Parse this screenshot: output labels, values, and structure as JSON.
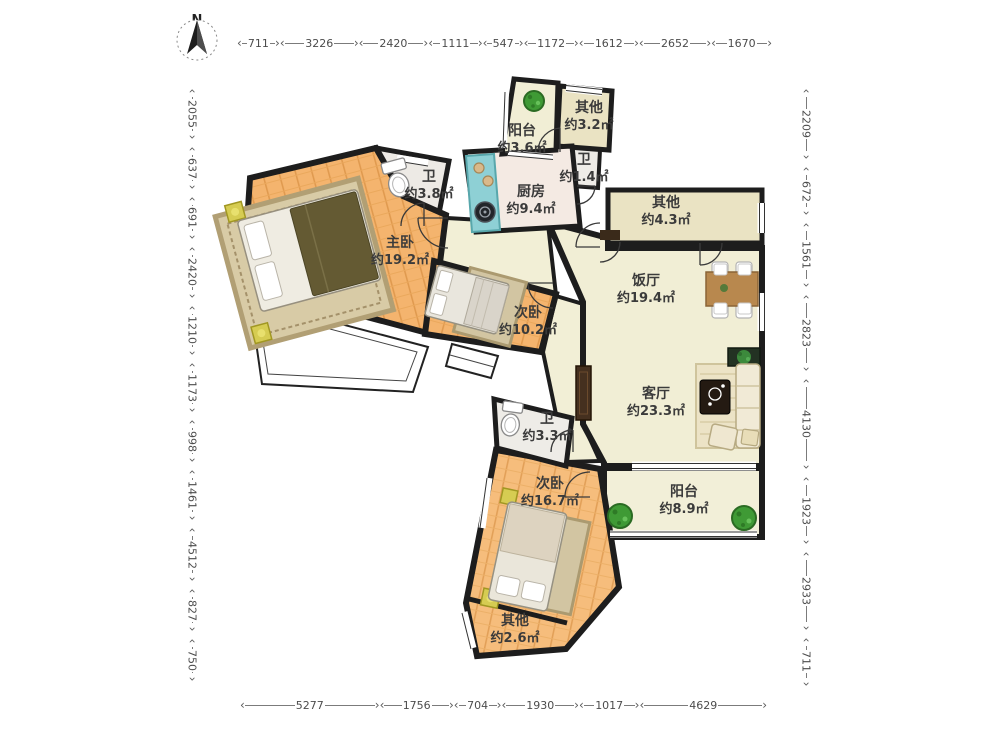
{
  "compass": {
    "north_label": "N"
  },
  "dimensions": {
    "top": [
      "711",
      "3226",
      "2420",
      "1111",
      "547",
      "1172",
      "1612",
      "2652",
      "1670"
    ],
    "left": [
      "2055",
      "637",
      "691",
      "2420",
      "1210",
      "1173",
      "998",
      "1461",
      "4512",
      "827",
      "750"
    ],
    "right": [
      "2209",
      "672",
      "1561",
      "2823",
      "4130",
      "1923",
      "2933",
      "711"
    ],
    "bottom": [
      "5277",
      "1756",
      "704",
      "1930",
      "1017",
      "4629"
    ]
  },
  "rooms": {
    "balcony_top": {
      "name": "阳台",
      "area": "约3.6㎡"
    },
    "other_top": {
      "name": "其他",
      "area": "约3.2㎡"
    },
    "bath_tiny": {
      "name": "卫",
      "area": "约1.4㎡"
    },
    "bath_left": {
      "name": "卫",
      "area": "约3.8㎡"
    },
    "kitchen": {
      "name": "厨房",
      "area": "约9.4㎡"
    },
    "other_right": {
      "name": "其他",
      "area": "约4.3㎡"
    },
    "master": {
      "name": "主卧",
      "area": "约19.2㎡"
    },
    "bedroom2": {
      "name": "次卧",
      "area": "约10.2㎡"
    },
    "dining": {
      "name": "饭厅",
      "area": "约19.4㎡"
    },
    "living": {
      "name": "客厅",
      "area": "约23.3㎡"
    },
    "bath_mid": {
      "name": "卫",
      "area": "约3.3㎡"
    },
    "bedroom3": {
      "name": "次卧",
      "area": "约16.7㎡"
    },
    "balcony_right": {
      "name": "阳台",
      "area": "约8.9㎡"
    },
    "other_bottom": {
      "name": "其他",
      "area": "约2.6㎡"
    }
  },
  "colors": {
    "wall": "#1d1d1d",
    "wood_floor": "#f4b46e",
    "wood_plank_line": "#e09a4f",
    "living_floor": "#f1eed5",
    "other_floor": "#eae3c3",
    "bath_floor": "#eeece7",
    "kitchen_floor": "#f4eae3",
    "counter_teal": "#8ed0d5",
    "plant_green": "#3f9a35",
    "rug": "#d8cba6",
    "dim_text": "#4c4c4c"
  }
}
